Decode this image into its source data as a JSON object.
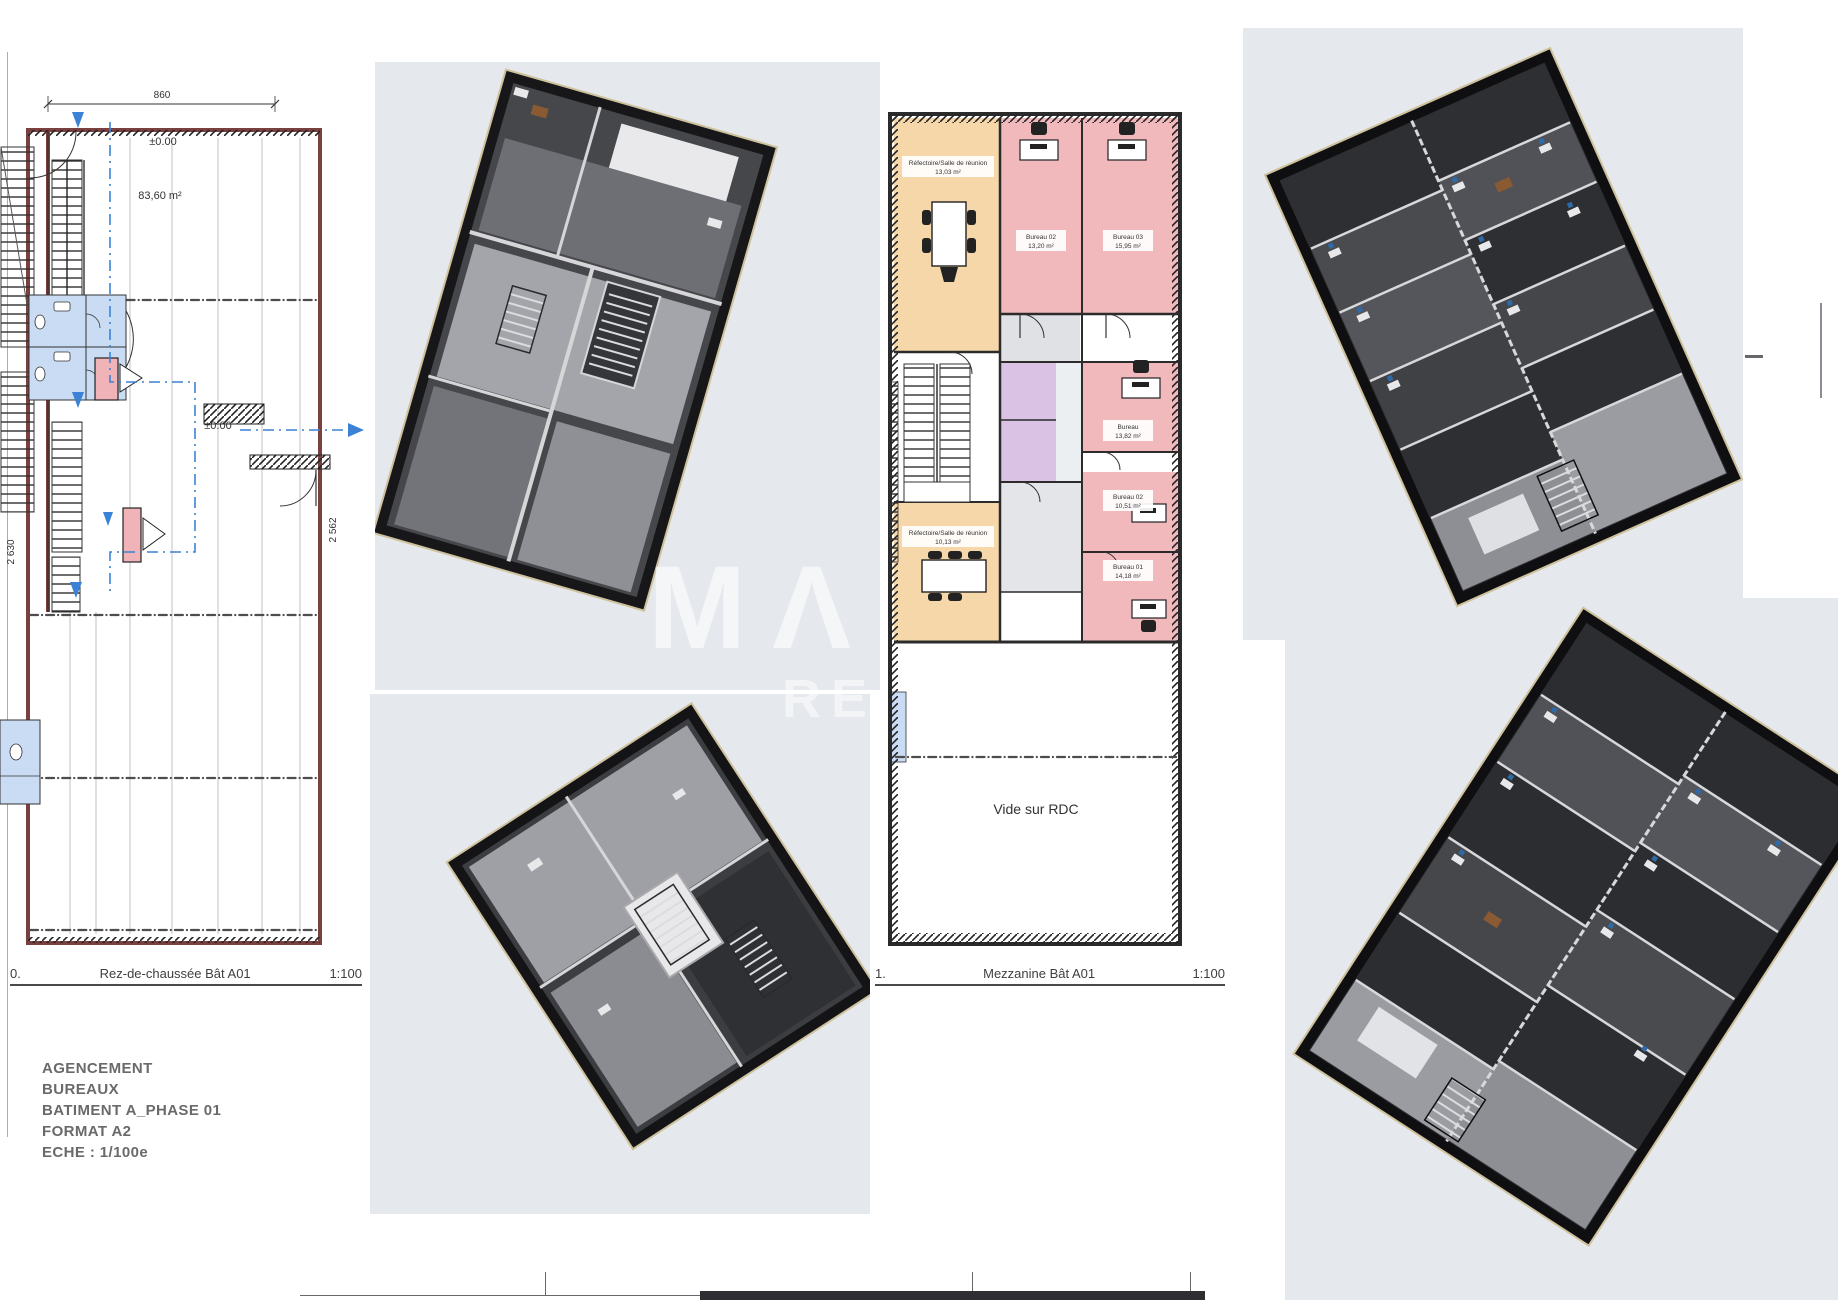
{
  "rdc_plan": {
    "dim_top": "860",
    "level_label_1": "±0.00",
    "area_label": "83,60 m²",
    "level_label_2": "±0.00",
    "dim_left": "2 630",
    "dim_right": "2 562",
    "caption_index": "0.",
    "caption_title": "Rez-de-chaussée Bât A01",
    "caption_scale": "1:100"
  },
  "mezzanine_plan": {
    "rooms": [
      {
        "name": "Réfectoire/Salle de réunion",
        "area": "13,03 m²"
      },
      {
        "name": "Bureau 02",
        "area": "13,20 m²"
      },
      {
        "name": "Bureau 03",
        "area": "15,95 m²"
      },
      {
        "name": "Bureau",
        "area": "13,82 m²"
      },
      {
        "name": "Bureau 02",
        "area": "10,51 m²"
      },
      {
        "name": "Bureau 01",
        "area": "14,18 m²"
      },
      {
        "name": "Réfectoire/Salle de réunion",
        "area": "10,13 m²"
      }
    ],
    "void_label": "Vide sur RDC",
    "caption_index": "1.",
    "caption_title": "Mezzanine Bât A01",
    "caption_scale": "1:100"
  },
  "title_block": {
    "line1": "AGENCEMENT",
    "line2": "BUREAUX",
    "line3": "BATIMENT A_PHASE 01",
    "line4": "FORMAT A2",
    "line5": "ECHE : 1/100e"
  },
  "watermark": {
    "line1": "MΛ",
    "line2": "RE"
  },
  "colors": {
    "panel_bg": "#e5e8ed",
    "wall_maroon": "#7a4040",
    "room_pink": "#f2b9bd",
    "room_orange": "#f6d7a9",
    "room_purple": "#d9c2e4",
    "room_blue": "#c9dcf4",
    "path_blue": "#3b82d6",
    "floor_dark": "#2e2f33",
    "floor_light": "#9fa0a6"
  }
}
